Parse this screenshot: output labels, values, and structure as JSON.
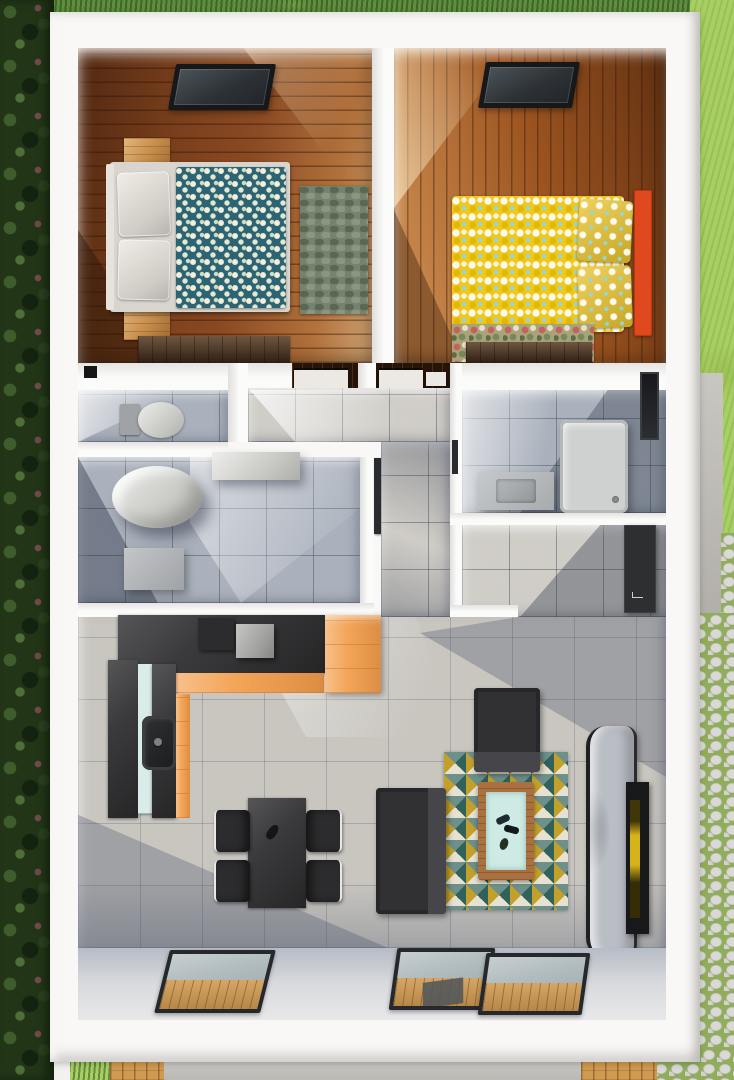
{
  "scene": {
    "kind": "3d-rendered-floor-plan-top-view",
    "description": "Photorealistic top-down 3D render of a small rectangular house with two bedrooms at the top, a WC, two bathrooms and a hallway in the middle band, and an open-plan kitchen / dining / living room at the bottom. The house is surrounded by a hedge on the left, lawn on the right, and a cobblestone path and wooden deck strips at the bottom right.",
    "house": {
      "rooms": [
        {
          "id": "bedroom-1",
          "name": "Bedroom 1",
          "floor": "dark reddish wood planks, horizontal",
          "furniture": [
            "ceiling skylight window",
            "double bed with teal floral duvet",
            "two grey-white pillows",
            "light grey bed frame with headboard",
            "oak nightstand (top)",
            "oak nightstand (bottom)",
            "grey-green leaf-pattern area rug",
            "dark walnut dresser along bottom wall"
          ]
        },
        {
          "id": "bedroom-2",
          "name": "Bedroom 2",
          "floor": "orange-brown wood planks, vertical",
          "furniture": [
            "ceiling skylight window",
            "double bed with yellow floral duvet",
            "two yellow floral pillows",
            "orange headboard panel on right wall",
            "multicolour floral rug",
            "dark walnut dresser along bottom wall"
          ]
        },
        {
          "id": "wc",
          "name": "WC",
          "floor": "blue-grey tiles",
          "furniture": [
            "toilet with cistern",
            "black wall vent"
          ]
        },
        {
          "id": "bathroom-1",
          "name": "Bathroom 1",
          "floor": "blue-grey tiles",
          "furniture": [
            "large cylindrical soaking tub",
            "wall vanity shelf",
            "grey storage cabinet",
            "open door leaf"
          ]
        },
        {
          "id": "bathroom-2",
          "name": "Bathroom 2",
          "floor": "blue-grey tiles",
          "furniture": [
            "washbasin counter with rectangular basin",
            "shower tray with drain",
            "dark wall window",
            "open door leaf"
          ]
        },
        {
          "id": "hallway",
          "name": "Hallway",
          "floor": "grey tiles",
          "furniture": [
            "two white bedroom door leaves in top wall"
          ]
        },
        {
          "id": "storage-nook",
          "name": "Storage nook",
          "floor": "grey tiles",
          "furniture": [
            "dark wall-mounted wardrobe panel"
          ]
        },
        {
          "id": "living-kitchen",
          "name": "Open-plan kitchen / dining / living room",
          "floor": "large light grey tiles",
          "furniture": [
            "L-shaped charcoal kitchen counter",
            "orange cabinet fronts",
            "tall orange cabinet",
            "mint-white fridge front",
            "dark kitchen sink with faucet",
            "grey countertop appliance cube",
            "dark dining table",
            "four black dining chairs",
            "charcoal armchair",
            "charcoal two-seat sofa",
            "triangle-mosaic rug",
            "wood coffee table with mint glass top and remotes",
            "grey curved chaise lounge",
            "wall-mounted TV with bright picture",
            "tilted floor-to-ceiling window (left)",
            "double sliding glass door (right) showing wood deck below"
          ]
        }
      ]
    },
    "exterior": {
      "features": [
        "dense green hedge along left side",
        "dark lawn strip along top",
        "bright lawn on upper right",
        "concrete side path on right",
        "cobblestone paving with grass joints on lower right",
        "concrete apron along bottom",
        "two wooden deck walkway strips at bottom",
        "white perimeter walls"
      ]
    }
  },
  "colors": {
    "house_wall": "#f9f8f6",
    "foliage": "#223617",
    "grass_top": "#5f8e3d",
    "lawn": "#a8cf63",
    "cobble_joint": "#8fad5a",
    "concrete": "#bdbab4",
    "concrete_bottom": "#c6c4bf",
    "deck_wood": "#cf9a51",
    "bedroom1_floor": "#8a4a22",
    "bedroom2_floor": "#9c5420",
    "duvet_teal": "#2d6474",
    "duvet_yellow": "#eec81a",
    "pillow_yellow": "#e9c32a",
    "headboard_orange": "#e0481d",
    "rug_leaf": "#75826f",
    "rug_floral": "#aaa379",
    "rug_triangle_base": "#d8d2bf",
    "oak": "#c9904e",
    "walnut": "#463020",
    "tile_bath": "#a9b0bb",
    "tile_living": "#c9c6c0",
    "tile_hall": "#cfccc6",
    "charcoal": "#3a3a3c",
    "charcoal_dark": "#2c2c2e",
    "orange_cabinet": "#f3a558",
    "mint": "#d9ece9",
    "fixture_grey": "#d2d2d0",
    "toilet_tank": "#9fa3a6",
    "shower_tray": "#cfd1d0",
    "wardrobe_dark": "#2e2f31",
    "tv_black": "#17181a",
    "tv_picture": "#d7b31a",
    "chaise_grey": "#b9bdc4",
    "sofa_dark": "#313134",
    "coffee_top": "#cdeae4",
    "coffee_frame": "#a9713f",
    "door_leaf": "#ece9e4",
    "doorway_dark": "#241409",
    "window_band": "#ccd0d6",
    "vent_black": "#161616"
  }
}
